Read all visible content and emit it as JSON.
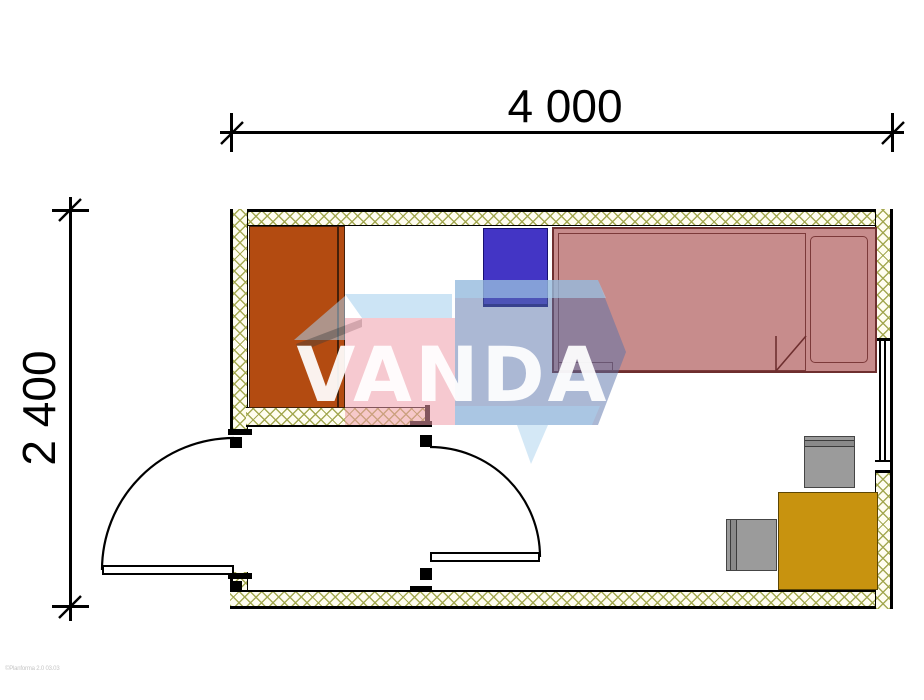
{
  "dimensions": {
    "width_label": "4 000",
    "height_label": "2 400"
  },
  "watermark": {
    "text": "VANDA",
    "pink": "#ee9daa",
    "blue": "#5872aa",
    "light_blue": "#aad2ee"
  },
  "footer": {
    "text": "©Planforma 2.0 03.03"
  },
  "plan": {
    "walls": {
      "hatch_line_color": "#a0a54b",
      "hatch_bg_color": "#fffdf0",
      "outline_color": "#000000"
    },
    "furniture": [
      {
        "name": "wardrobe",
        "color": "#b34b11"
      },
      {
        "name": "nightstand",
        "color": "#4335c5"
      },
      {
        "name": "bed",
        "color": "#c78c8c",
        "outline": "#6e2f2f"
      },
      {
        "name": "desk",
        "color": "#c8930f"
      },
      {
        "name": "chair-top",
        "color": "#9b9b9b"
      },
      {
        "name": "chair-left",
        "color": "#9b9b9b"
      }
    ],
    "openings": {
      "doors": 2,
      "windows": 1
    }
  }
}
